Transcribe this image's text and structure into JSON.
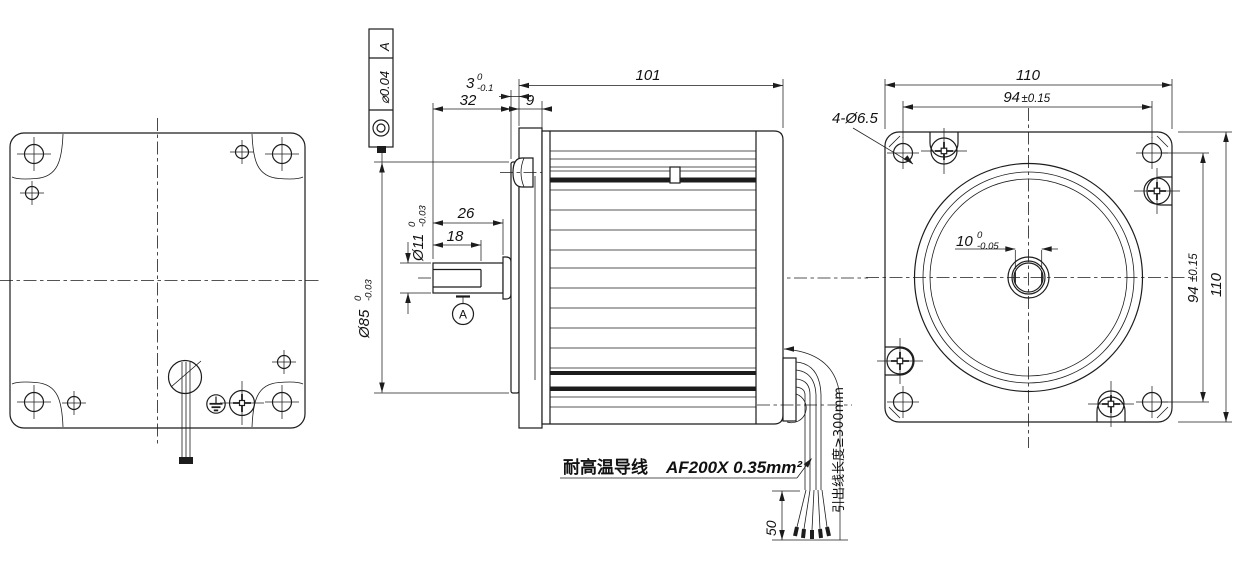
{
  "tolerance_frame": {
    "symbol": "concentricity",
    "value": "⌀0.04",
    "datum": "A"
  },
  "datum": {
    "label": "A"
  },
  "dimensions": {
    "boss_thickness": {
      "main": "3",
      "sup": "0",
      "sub": "-0.1"
    },
    "shaft_end_to_flange": "32",
    "flange_thickness": "9",
    "body_length": "101",
    "shaft_length": "26",
    "flat_length": "18",
    "shaft_dia": {
      "main": "Ø11",
      "sup": "0",
      "sub": "-0.03"
    },
    "boss_dia": {
      "main": "Ø85",
      "sup": "0",
      "sub": "-0.03"
    },
    "strip_length": "50",
    "front_width": "110",
    "front_hole_span": {
      "main": "94",
      "tol": "±0.15"
    },
    "front_height": "110",
    "front_hole_span_v": {
      "main": "94",
      "tol": "±0.15"
    },
    "mount_holes": "4-Ø6.5",
    "across_flats": {
      "main": "10",
      "sup": "0",
      "sub": "-0.05"
    }
  },
  "labels": {
    "wire_material": "耐高温导线",
    "wire_spec": "AF200X 0.35mm²",
    "lead_length": "引出线长度≥300mm"
  },
  "colors": {
    "line": "#1c1c1c",
    "background": "#ffffff"
  }
}
